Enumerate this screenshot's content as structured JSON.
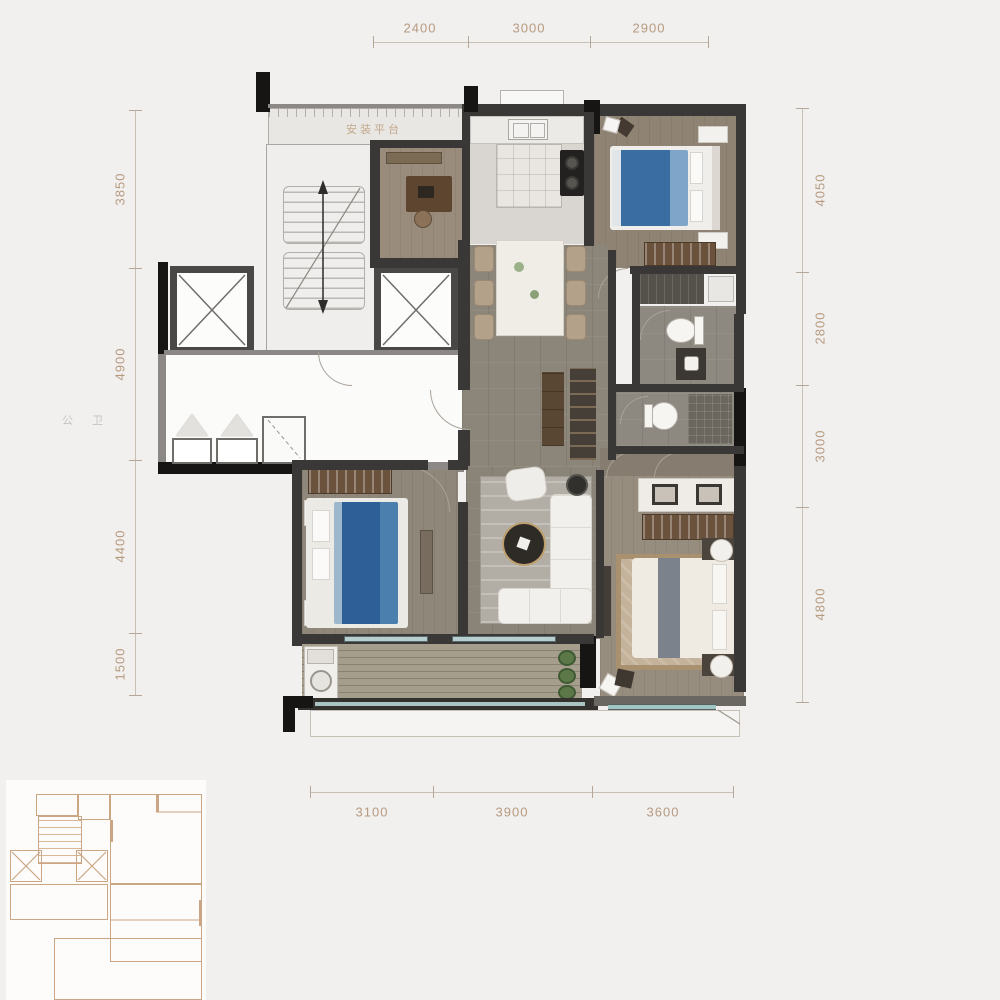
{
  "title": "residential-unit-floor-plan",
  "dimensions": {
    "top": [
      "2400",
      "3000",
      "2900"
    ],
    "bottom": [
      "3100",
      "3900",
      "3600"
    ],
    "left": [
      "3850",
      "4900",
      "4400",
      "1500"
    ],
    "right": [
      "4050",
      "2800",
      "3000",
      "4800"
    ]
  },
  "plan": {
    "platform_label": "安装平台",
    "side_label": "公 卫"
  },
  "colors": {
    "page_background": "#f1f0ee",
    "dimension_text": "#b79b80",
    "dimension_line": "#c9c0b5",
    "wall_dark": "#3a3836",
    "wall_black": "#161514",
    "wall_public": "#8b8885",
    "floor_tile_gray": "#8c857b",
    "floor_wood": "#948a7b",
    "kitchen_marble": "#e9e6e1",
    "bed_blue": "#3a6da2",
    "bed_cream": "#efeae2",
    "wardrobe_brown": "#6a523c",
    "glass_teal": "#9fc6c4",
    "balcony_wood": "#a59e8c",
    "rug_master": "#c4b29a",
    "inset_line": "#cba684"
  }
}
